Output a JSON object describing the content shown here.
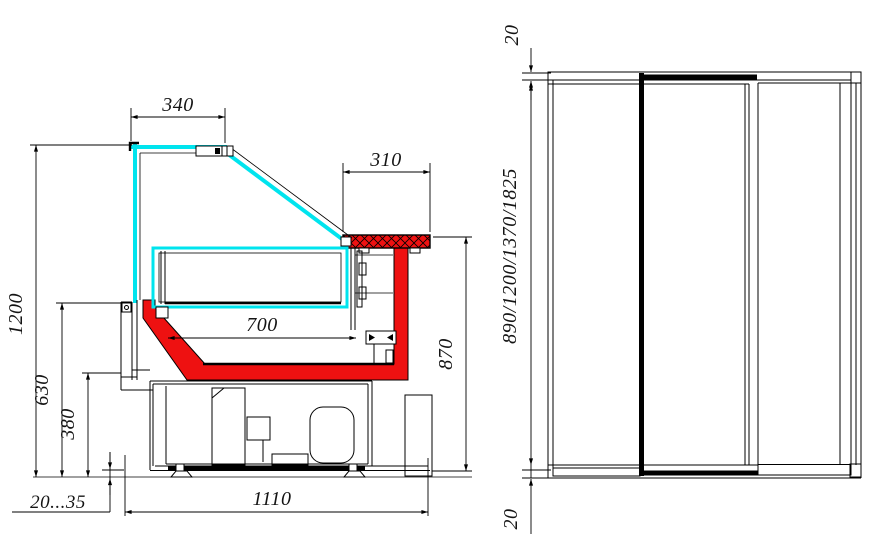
{
  "dimensions": {
    "canopy_depth": "340",
    "counter_depth": "310",
    "overall_height": "1200",
    "front_panel_height": "630",
    "base_height": "380",
    "foot_adjust_range": "20...35",
    "overall_depth": "1110",
    "deck_depth": "700",
    "counter_height": "870",
    "side_top_thickness": "20",
    "length_variants": "890/1200/1370/1825",
    "side_bottom_thickness": "20"
  },
  "colors": {
    "glass_cyan": "#00e4ee",
    "liner_red": "#ee1111",
    "line_black": "#000000",
    "paper_white": "#ffffff"
  }
}
